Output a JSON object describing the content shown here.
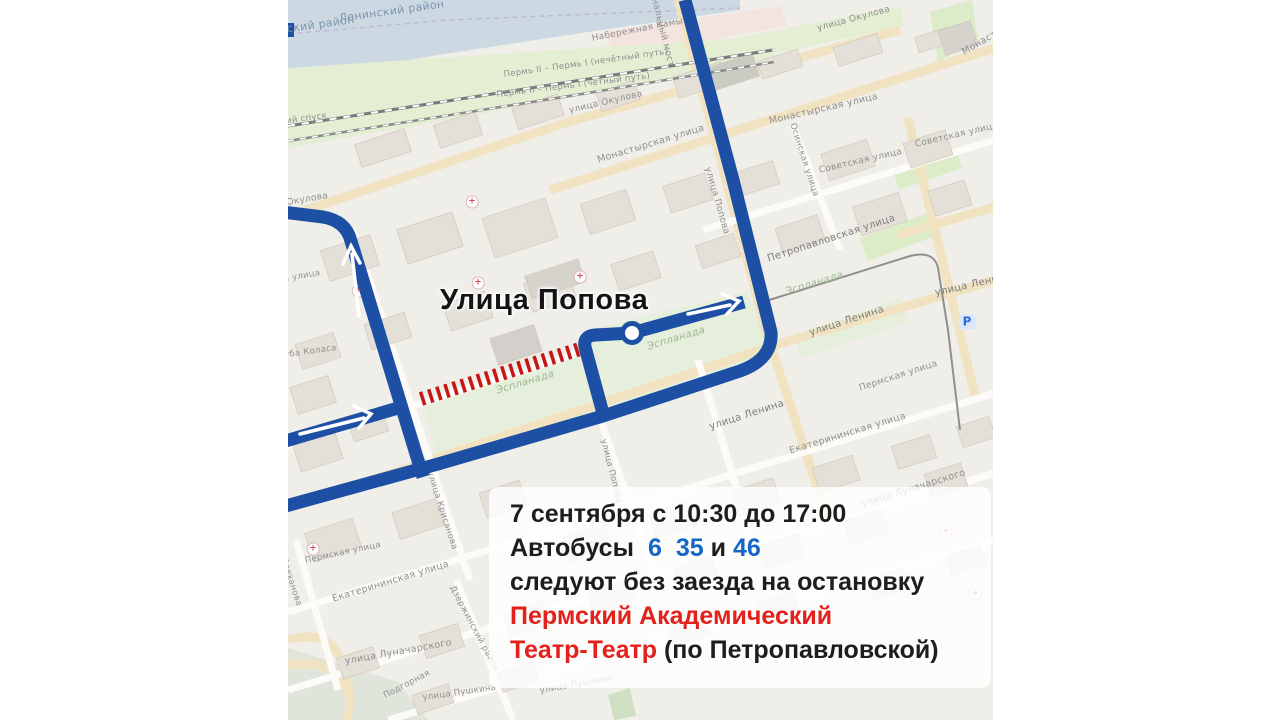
{
  "map": {
    "annotation": "Улица Попова",
    "labels": [
      {
        "t": "Ленинский район",
        "x": 50,
        "y": 12,
        "r": -8,
        "s": 11,
        "c": "#7c95ab"
      },
      {
        "t": "Дзержинский район",
        "x": -56,
        "y": 30,
        "r": -8,
        "s": 11,
        "c": "#7c95ab"
      },
      {
        "t": "Набережная Камы",
        "x": 303,
        "y": 34,
        "r": -11,
        "s": 9
      },
      {
        "t": "Пермь II – Пермь I (нечётный путь)",
        "x": 215,
        "y": 70,
        "r": -8,
        "s": 8.5
      },
      {
        "t": "Пермь II – Пермь I (четный путь)",
        "x": 208,
        "y": 90,
        "r": -7,
        "s": 8.5
      },
      {
        "t": "улица Окулова",
        "x": 280,
        "y": 106,
        "r": -13,
        "s": 9
      },
      {
        "t": "улица Окулова",
        "x": 528,
        "y": 24,
        "r": -15,
        "s": 9
      },
      {
        "t": "улица Окулова",
        "x": -35,
        "y": 204,
        "r": -10,
        "s": 9
      },
      {
        "t": "Монастырская улица",
        "x": 308,
        "y": 155,
        "r": -17,
        "s": 9.5
      },
      {
        "t": "Монастырская улица",
        "x": 480,
        "y": 116,
        "r": -13,
        "s": 9.5
      },
      {
        "t": "Монастырская улица",
        "x": 672,
        "y": 48,
        "r": -30,
        "s": 9.5
      },
      {
        "t": "Осинская улица",
        "x": 509,
        "y": 122,
        "r": 72,
        "s": 8.5
      },
      {
        "t": "Советская улица",
        "x": 530,
        "y": 166,
        "r": -13,
        "s": 9
      },
      {
        "t": "Советская улица",
        "x": 626,
        "y": 140,
        "r": -13,
        "s": 9
      },
      {
        "t": "Петропавловская улица",
        "x": 478,
        "y": 254,
        "r": -18,
        "s": 10,
        "c": "#7d7d7d"
      },
      {
        "t": "улица Ленина",
        "x": 520,
        "y": 328,
        "r": -18,
        "s": 10,
        "c": "#7d7d7d"
      },
      {
        "t": "улица Ленина",
        "x": 646,
        "y": 288,
        "r": -13,
        "s": 10,
        "c": "#7d7d7d"
      },
      {
        "t": "улица Ленина",
        "x": 420,
        "y": 422,
        "r": -18,
        "s": 10,
        "c": "#7d7d7d"
      },
      {
        "t": "Пермская улица",
        "x": 570,
        "y": 384,
        "r": -18,
        "s": 9
      },
      {
        "t": "Пермская улица",
        "x": 16,
        "y": 556,
        "r": -12,
        "s": 8.5
      },
      {
        "t": "Екатерининская улица",
        "x": 43,
        "y": 594,
        "r": -17,
        "s": 9.5
      },
      {
        "t": "Екатерининская улица",
        "x": 500,
        "y": 446,
        "r": -17,
        "s": 9.5
      },
      {
        "t": "улица Луначарского",
        "x": 56,
        "y": 656,
        "r": -10,
        "s": 9.5
      },
      {
        "t": "улица Луначарского",
        "x": 572,
        "y": 499,
        "r": -17,
        "s": 9.5
      },
      {
        "t": "улица Пушкина",
        "x": 134,
        "y": 693,
        "r": -8,
        "s": 8.5
      },
      {
        "t": "улица Пушкина",
        "x": 251,
        "y": 686,
        "r": -10,
        "s": 8.5
      },
      {
        "t": "улица Крисанова",
        "x": 146,
        "y": 470,
        "r": 72,
        "s": 8.5
      },
      {
        "t": "улица Попова",
        "x": 424,
        "y": 166,
        "r": 74,
        "s": 9
      },
      {
        "t": "улица Попова",
        "x": 320,
        "y": 438,
        "r": 76,
        "s": 8.5
      },
      {
        "t": "Плеханова",
        "x": 0,
        "y": 556,
        "r": 72,
        "s": 8.5
      },
      {
        "t": "Дзержинский район",
        "x": 168,
        "y": 584,
        "r": 62,
        "s": 8.5
      },
      {
        "t": "Коммунальный мост",
        "x": 363,
        "y": -34,
        "r": 76,
        "s": 9
      },
      {
        "t": "Якуба Коласа",
        "x": -16,
        "y": 352,
        "r": -8,
        "s": 8.5
      },
      {
        "t": "Решетниковский спуск",
        "x": -70,
        "y": 126,
        "r": -8,
        "s": 8.5
      },
      {
        "t": "Советская улица",
        "x": -48,
        "y": 282,
        "r": -10,
        "s": 8.5
      },
      {
        "t": "Подгорная",
        "x": 94,
        "y": 692,
        "r": -28,
        "s": 8.5
      },
      {
        "t": "Эспланада",
        "x": 207,
        "y": 386,
        "r": -17,
        "s": 10,
        "c": "#9cb795",
        "i": 1
      },
      {
        "t": "Эспланада",
        "x": 358,
        "y": 342,
        "r": -17,
        "s": 10,
        "c": "#9cb795",
        "i": 1
      },
      {
        "t": "Эспланада",
        "x": 496,
        "y": 287,
        "r": -17,
        "s": 10,
        "c": "#9cb795",
        "i": 1
      }
    ],
    "cross_glyph": "+",
    "cross_icons": [
      [
        25,
        549
      ],
      [
        70,
        291
      ],
      [
        184,
        202
      ],
      [
        190,
        283
      ],
      [
        292,
        277
      ],
      [
        658,
        532
      ],
      [
        687,
        594
      ]
    ],
    "parking_icon": {
      "x": 679,
      "y": 322,
      "glyph": "P"
    },
    "colors": {
      "route_blue": "#1d4fa5",
      "closure_red": "#c51717",
      "stop_fill": "#ffffff"
    }
  },
  "info_box": {
    "line1": "7 сентября с 10:30 до 17:00",
    "line2_prefix": "Автобусы",
    "line2_num1": "6",
    "line2_num2": "35",
    "line2_and": "и",
    "line2_num3": "46",
    "line3": "следуют без заезда на остановку",
    "line4": "Пермский Академический",
    "line5_red": "Театр-Театр",
    "line5_black": "(по Петропавловской)"
  }
}
